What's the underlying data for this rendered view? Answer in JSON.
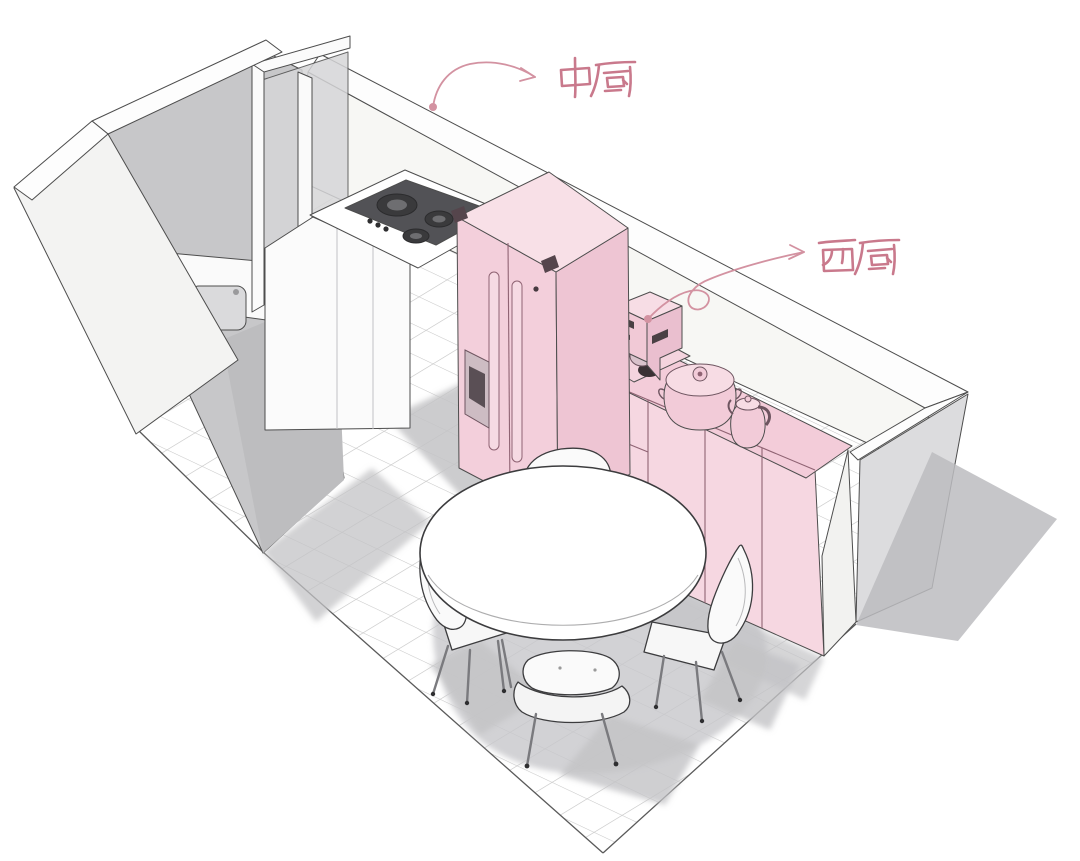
{
  "image": {
    "kind": "3d-kitchen-interior-rendering",
    "width": 1080,
    "height": 861
  },
  "annotations": {
    "chinese_kitchen": {
      "text": "中厨",
      "color": "#c9798c"
    },
    "western_kitchen": {
      "text": "西厨",
      "color": "#c9798c"
    }
  },
  "palette": {
    "white": "#ffffff",
    "wall_face": "#f7f7f4",
    "wall_top": "#fdfdfd",
    "wall_outer": "#f3f3f2",
    "wall_gray": "#c7c7c9",
    "wall_gray_dark": "#bdbdbf",
    "wall_end": "#dcdcde",
    "glass": "#d6d6d8",
    "floor_line": "#c7c7c7",
    "shadow": "#c3c3c6",
    "fridge_front": "#f3cfdb",
    "fridge_top": "#f8e0e7",
    "fridge_side": "#eec5d3",
    "cabinet_front": "#f6d7e1",
    "cabinet_top": "#f3ccd9",
    "appliance_pink": "#f2cbd8",
    "pink_line": "#8f6373",
    "cooktop": "#525256",
    "outline": "#4d4d4d",
    "label": "#c9798c",
    "arrow": "#d392a1"
  },
  "scene": {
    "room": "kitchen",
    "zones": [
      "中厨",
      "西厨"
    ],
    "objects": [
      "gas-cooktop",
      "refrigerator",
      "coffee-machine",
      "rice-cooker",
      "electric-kettle",
      "dining-table",
      "dining-chairs",
      "utility-sink",
      "window-partition",
      "tiled-floor"
    ],
    "counts": {
      "dining_chairs": 4,
      "cooktop_burners": 3
    }
  }
}
